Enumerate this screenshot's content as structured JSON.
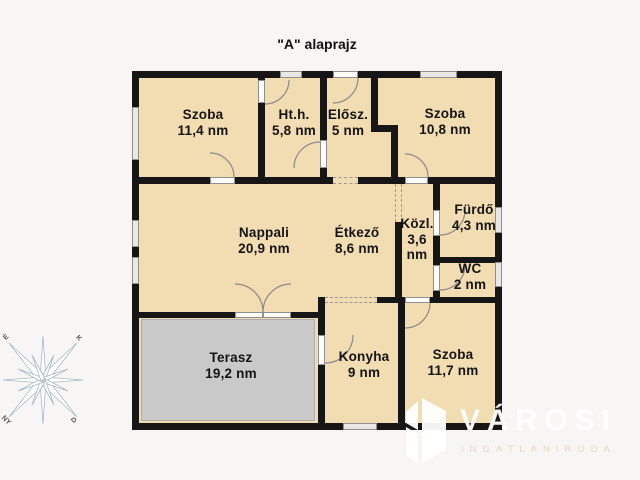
{
  "title": "\"A\" alaprajz",
  "rooms": [
    {
      "name": "Szoba",
      "area": "11,4 nm"
    },
    {
      "name": "Ht.h.",
      "area": "5,8 nm"
    },
    {
      "name": "Elősz.",
      "area": "5 nm"
    },
    {
      "name": "Szoba",
      "area": "10,8 nm"
    },
    {
      "name": "Nappali",
      "area": "20,9 nm"
    },
    {
      "name": "Étkező",
      "area": "8,6 nm"
    },
    {
      "name": "Közl.",
      "area": "3,6 nm"
    },
    {
      "name": "Fürdő",
      "area": "4,3 nm"
    },
    {
      "name": "WC",
      "area": "2 nm"
    },
    {
      "name": "Terasz",
      "area": "19,2 nm"
    },
    {
      "name": "Konyha",
      "area": "9 nm"
    },
    {
      "name": "Szoba",
      "area": "11,7 nm"
    }
  ],
  "compass": {
    "north": "É",
    "east": "K",
    "west": "NY",
    "south": "D"
  },
  "logo": {
    "brand": "VÁROSI",
    "subtitle": "INGATLANIRODA"
  },
  "colors": {
    "background": "#F7F6F4",
    "room_fill": "#F2DCB2",
    "wall": "#161616",
    "terrace_fill": "#C9C9C9",
    "window_fill": "#E8E8E8"
  }
}
